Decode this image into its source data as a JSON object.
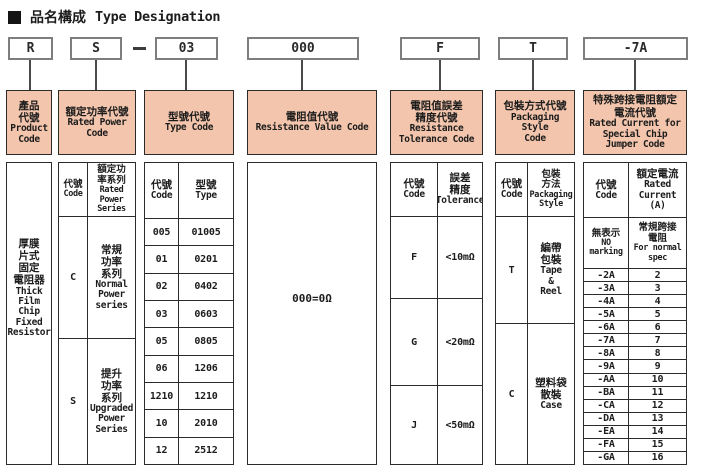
{
  "title": {
    "cjk": "品名構成",
    "en": "Type Designation"
  },
  "code_boxes": {
    "product": "R",
    "power": "S",
    "separator": "—",
    "type": "03",
    "resistance": "000",
    "tolerance": "F",
    "packaging": "T",
    "jumper": "-7A"
  },
  "columns": {
    "product": {
      "header_cjk": "產品\n代號",
      "header_en": "Product\nCode",
      "body_cjk": "厚膜\n片式\n固定\n電阻器",
      "body_en": "Thick\nFilm\nChip\nFixed\nResistor"
    },
    "power": {
      "header_cjk": "額定功率代號",
      "header_en": "Rated Power\nCode",
      "subheader": {
        "code_cjk": "代號",
        "code_en": "Code",
        "desc_cjk": "額定功\n率系列",
        "desc_en": "Rated\nPower\nSeries"
      },
      "rows": [
        {
          "code": "C",
          "desc_cjk": "常規\n功率\n系列",
          "desc_en": "Normal\nPower\nseries"
        },
        {
          "code": "S",
          "desc_cjk": "提升\n功率\n系列",
          "desc_en": "Upgraded\nPower\nSeries"
        }
      ]
    },
    "type": {
      "header_cjk": "型號代號",
      "header_en": "Type Code",
      "subheader": {
        "code_cjk": "代號",
        "code_en": "Code",
        "desc_cjk": "型號",
        "desc_en": "Type"
      },
      "rows": [
        {
          "code": "005",
          "type": "01005"
        },
        {
          "code": "01",
          "type": "0201"
        },
        {
          "code": "02",
          "type": "0402"
        },
        {
          "code": "03",
          "type": "0603"
        },
        {
          "code": "05",
          "type": "0805"
        },
        {
          "code": "06",
          "type": "1206"
        },
        {
          "code": "1210",
          "type": "1210"
        },
        {
          "code": "10",
          "type": "2010"
        },
        {
          "code": "12",
          "type": "2512"
        }
      ]
    },
    "resistance": {
      "header_cjk": "電阻值代號",
      "header_en": "Resistance Value Code",
      "body": "000=0Ω"
    },
    "tolerance": {
      "header_cjk": "電阻值誤差\n精度代號",
      "header_en": "Resistance\nTolerance Code",
      "subheader": {
        "code_cjk": "代號",
        "code_en": "Code",
        "desc_cjk": "誤差\n精度",
        "desc_en": "Tolerance"
      },
      "rows": [
        {
          "code": "F",
          "value": "<10mΩ"
        },
        {
          "code": "G",
          "value": "<20mΩ"
        },
        {
          "code": "J",
          "value": "<50mΩ"
        }
      ]
    },
    "packaging": {
      "header_cjk": "包裝方式代號",
      "header_en": "Packaging Style\nCode",
      "subheader": {
        "code_cjk": "代號",
        "code_en": "Code",
        "desc_cjk": "包裝\n方法",
        "desc_en": "Packaging\nStyle"
      },
      "rows": [
        {
          "code": "T",
          "desc_cjk": "編帶\n包裝",
          "desc_en": "Tape\n&\nReel"
        },
        {
          "code": "C",
          "desc_cjk": "塑料袋\n散裝",
          "desc_en": "Case"
        }
      ]
    },
    "jumper": {
      "header_cjk": "特殊跨接電阻額定\n電流代號",
      "header_en": "Rated Current for\nSpecial Chip\nJumper Code",
      "subheader": {
        "code_cjk": "代號",
        "code_en": "Code",
        "desc_cjk": "額定電流",
        "desc_en": "Rated\nCurrent\n(A)"
      },
      "special_row": {
        "code_cjk": "無表示",
        "code_en": "NO\nmarking",
        "desc_cjk": "常規跨接\n電阻",
        "desc_en": "For normal\nspec"
      },
      "rows": [
        {
          "code": "-2A",
          "value": "2"
        },
        {
          "code": "-3A",
          "value": "3"
        },
        {
          "code": "-4A",
          "value": "4"
        },
        {
          "code": "-5A",
          "value": "5"
        },
        {
          "code": "-6A",
          "value": "6"
        },
        {
          "code": "-7A",
          "value": "7"
        },
        {
          "code": "-8A",
          "value": "8"
        },
        {
          "code": "-9A",
          "value": "9"
        },
        {
          "code": "-AA",
          "value": "10"
        },
        {
          "code": "-BA",
          "value": "11"
        },
        {
          "code": "-CA",
          "value": "12"
        },
        {
          "code": "-DA",
          "value": "13"
        },
        {
          "code": "-EA",
          "value": "14"
        },
        {
          "code": "-FA",
          "value": "15"
        },
        {
          "code": "-GA",
          "value": "16"
        }
      ]
    }
  },
  "colors": {
    "header_bg": "#f3c5ac",
    "table_border": "#2b2b2b",
    "code_box_border": "#7e7e7e"
  }
}
